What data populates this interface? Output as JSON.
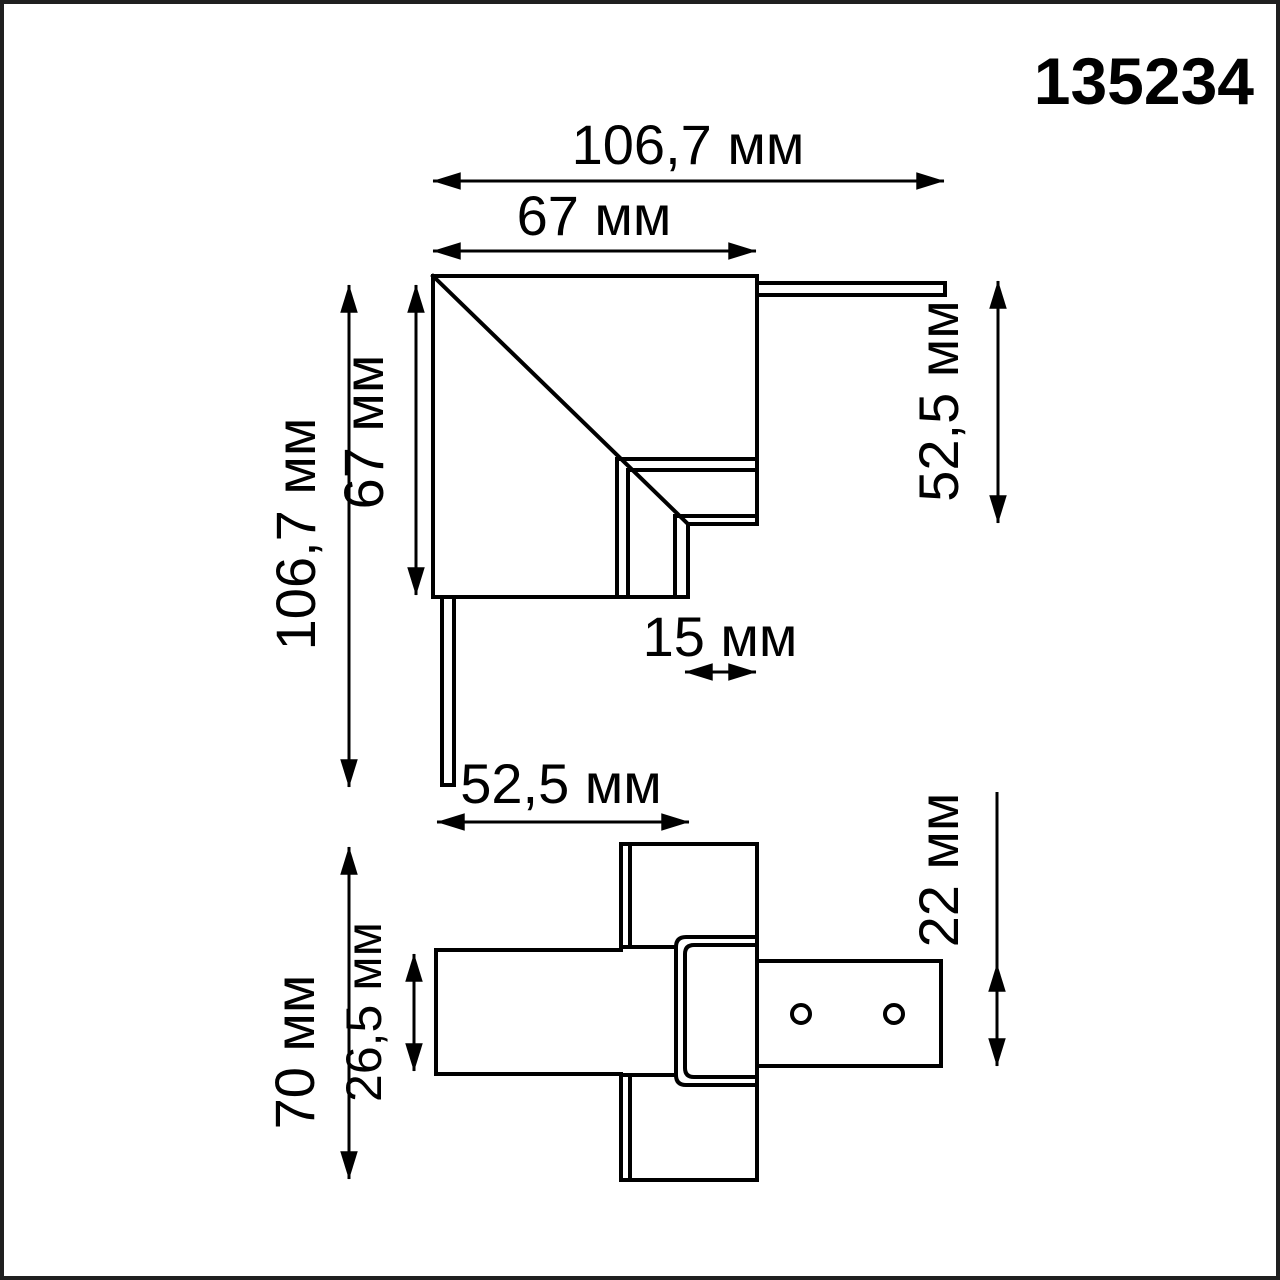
{
  "part_number": "135234",
  "colors": {
    "line": "#000000",
    "background": "#ffffff",
    "frame": "#1f1f1f"
  },
  "top_view": {
    "name": "corner-connector-top-view",
    "dims": {
      "width_total": "106,7 мм",
      "width_inner": "67 мм",
      "height_total": "106,7 мм",
      "height_inner": "67 мм",
      "side_right": "52,5 мм",
      "step": "15 мм"
    }
  },
  "bottom_view": {
    "name": "corner-connector-bottom-view",
    "dims": {
      "width_top": "52,5 мм",
      "height_total": "70 мм",
      "height_inner": "26,5 мм",
      "plate_height": "22 мм"
    }
  }
}
